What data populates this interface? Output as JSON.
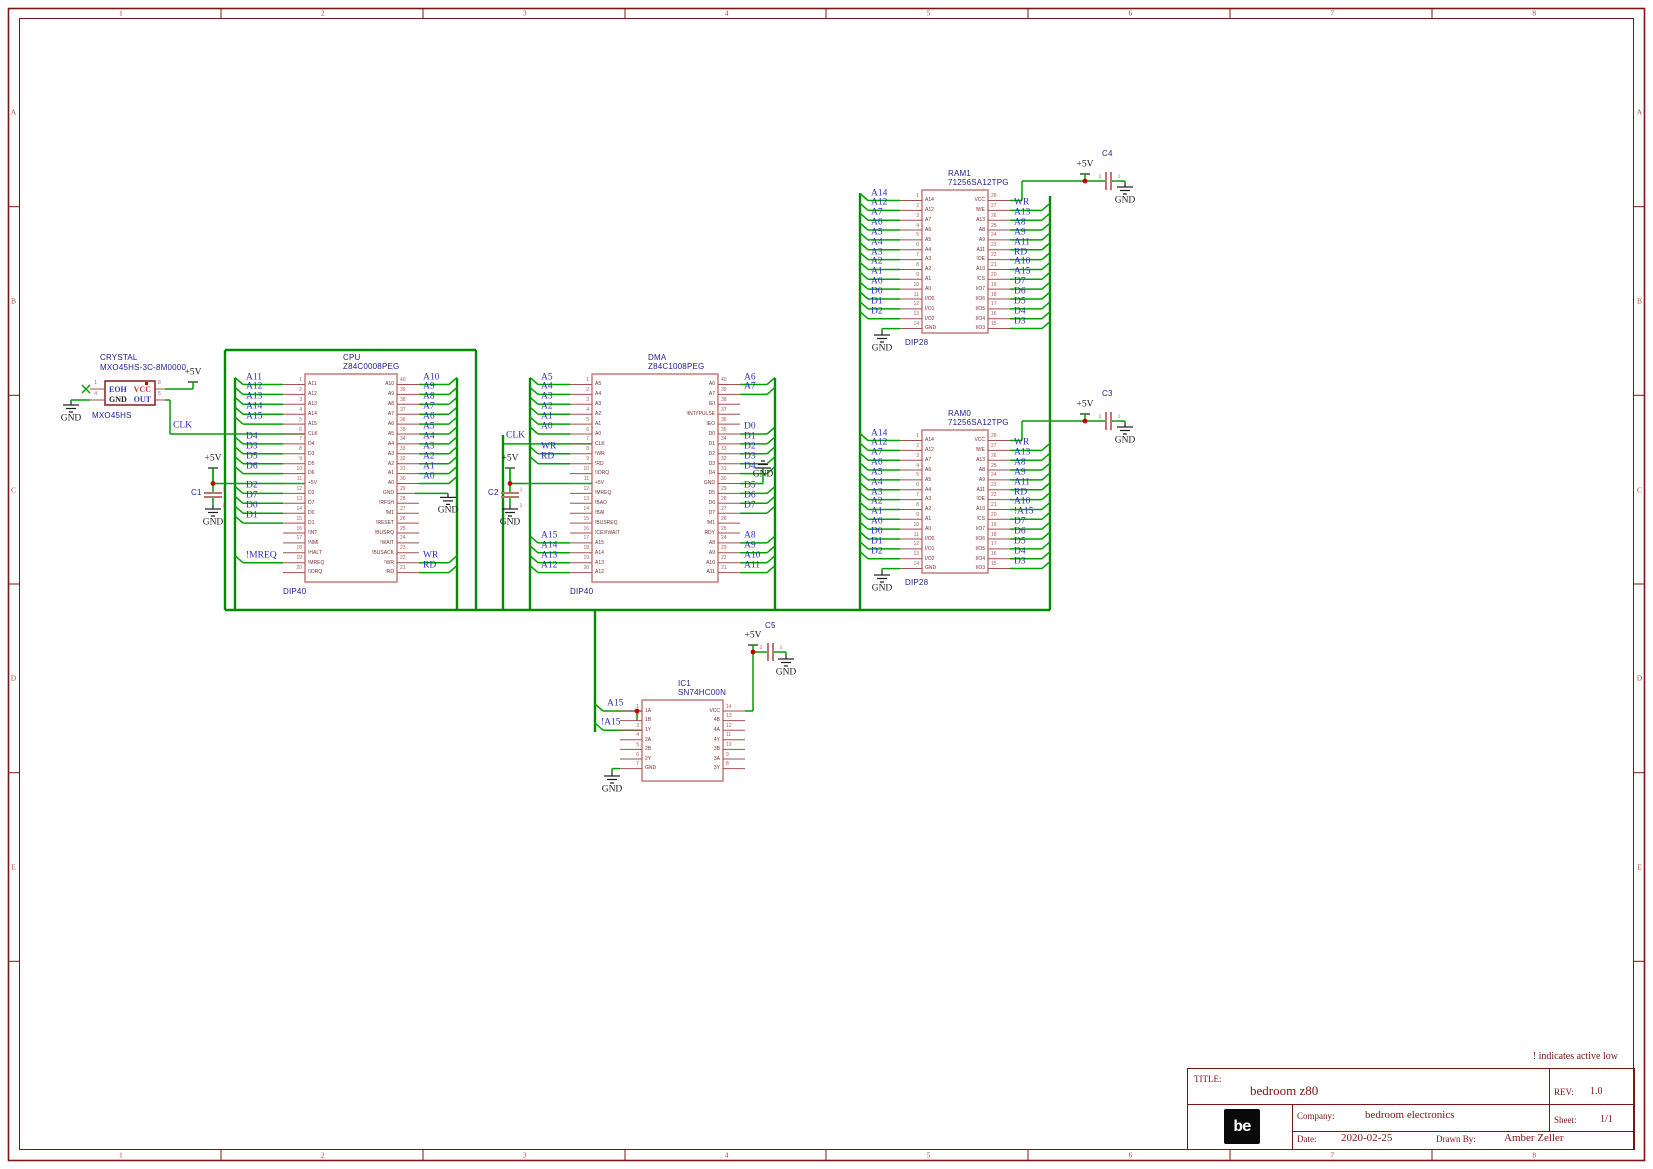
{
  "sheet": {
    "note": "! indicates active low",
    "frame": {
      "columns": [
        "1",
        "2",
        "3",
        "4",
        "5",
        "6",
        "7",
        "8"
      ],
      "rows": [
        "A",
        "B",
        "C",
        "D",
        "E"
      ]
    },
    "title_block": {
      "title_label": "TITLE:",
      "title": "bedroom z80",
      "rev_label": "REV:",
      "rev": "1.0",
      "company_label": "Company:",
      "company": "bedroom electronics",
      "sheet_label": "Sheet:",
      "sheet": "1/1",
      "date_label": "Date:",
      "date": "2020-02-25",
      "drawn_by_label": "Drawn By:",
      "drawn_by": "Amber Zeller",
      "logo_text": "be"
    }
  },
  "power": {
    "v5": "+5V",
    "gnd": "GND"
  },
  "labels": [
    "CLK",
    "CLK",
    "A15",
    "!A15"
  ],
  "colors": {
    "wire_green": "#00a000",
    "bus_green": "#008c00",
    "chip_outline": "#bf7373",
    "pin_stub": "#9e5252",
    "pin_number": "#b25858",
    "pin_name": "#7c2d2d",
    "net_label_blue": "#2d2dc4",
    "component_title_navy": "#1c1c91",
    "frame_red": "#7c1414",
    "junction_red": "#c00000",
    "symbol_black": "#1c1c1c"
  },
  "crystal": {
    "label_lines": [
      "CRYSTAL",
      "MXO45HS-3C-8M0000"
    ],
    "footprint": "MXO45HS",
    "pins": [
      {
        "num": "1",
        "name": "EOH"
      },
      {
        "num": "4",
        "name": "GND"
      },
      {
        "num": "8",
        "name": "VCC"
      },
      {
        "num": "5",
        "name": "OUT"
      }
    ]
  },
  "capacitors": [
    {
      "ref": "C1"
    },
    {
      "ref": "C2"
    },
    {
      "ref": "C3"
    },
    {
      "ref": "C4"
    },
    {
      "ref": "C5"
    }
  ],
  "chips": [
    {
      "ref": "CPU",
      "part": "Z84C0008PEG",
      "package": "DIP40",
      "left": [
        {
          "num": 1,
          "name": "A11",
          "net": "A11"
        },
        {
          "num": 2,
          "name": "A12",
          "net": "A12"
        },
        {
          "num": 3,
          "name": "A13",
          "net": "A13"
        },
        {
          "num": 4,
          "name": "A14",
          "net": "A14"
        },
        {
          "num": 5,
          "name": "A15",
          "net": "A15"
        },
        {
          "num": 6,
          "name": "CLK",
          "net": ""
        },
        {
          "num": 7,
          "name": "D4",
          "net": "D4"
        },
        {
          "num": 8,
          "name": "D3",
          "net": "D3"
        },
        {
          "num": 9,
          "name": "D5",
          "net": "D5"
        },
        {
          "num": 10,
          "name": "D6",
          "net": "D6"
        },
        {
          "num": 11,
          "name": "+5V",
          "net": ""
        },
        {
          "num": 12,
          "name": "D2",
          "net": "D2"
        },
        {
          "num": 13,
          "name": "D7",
          "net": "D7"
        },
        {
          "num": 14,
          "name": "D0",
          "net": "D0"
        },
        {
          "num": 15,
          "name": "D1",
          "net": "D1"
        },
        {
          "num": 16,
          "name": "!INT",
          "net": ""
        },
        {
          "num": 17,
          "name": "!NMI",
          "net": ""
        },
        {
          "num": 18,
          "name": "!HALT",
          "net": ""
        },
        {
          "num": 19,
          "name": "!MREQ",
          "net": "!MREQ"
        },
        {
          "num": 20,
          "name": "!IORQ",
          "net": ""
        }
      ],
      "right": [
        {
          "num": 40,
          "name": "A10",
          "net": "A10"
        },
        {
          "num": 39,
          "name": "A9",
          "net": "A9"
        },
        {
          "num": 38,
          "name": "A8",
          "net": "A8"
        },
        {
          "num": 37,
          "name": "A7",
          "net": "A7"
        },
        {
          "num": 36,
          "name": "A6",
          "net": "A6"
        },
        {
          "num": 35,
          "name": "A5",
          "net": "A5"
        },
        {
          "num": 34,
          "name": "A4",
          "net": "A4"
        },
        {
          "num": 33,
          "name": "A3",
          "net": "A3"
        },
        {
          "num": 32,
          "name": "A2",
          "net": "A2"
        },
        {
          "num": 31,
          "name": "A1",
          "net": "A1"
        },
        {
          "num": 30,
          "name": "A0",
          "net": "A0"
        },
        {
          "num": 29,
          "name": "GND",
          "net": ""
        },
        {
          "num": 28,
          "name": "!RFSH",
          "net": ""
        },
        {
          "num": 27,
          "name": "!M1",
          "net": ""
        },
        {
          "num": 26,
          "name": "!RESET",
          "net": ""
        },
        {
          "num": 25,
          "name": "!BUSRQ",
          "net": ""
        },
        {
          "num": 24,
          "name": "!WAIT",
          "net": ""
        },
        {
          "num": 23,
          "name": "!BUSACK",
          "net": ""
        },
        {
          "num": 22,
          "name": "!WR",
          "net": "WR"
        },
        {
          "num": 21,
          "name": "!RD",
          "net": "RD"
        }
      ]
    },
    {
      "ref": "DMA",
      "part": "Z84C1008PEG",
      "package": "DIP40",
      "left": [
        {
          "num": 1,
          "name": "A5",
          "net": "A5"
        },
        {
          "num": 2,
          "name": "A4",
          "net": "A4"
        },
        {
          "num": 3,
          "name": "A3",
          "net": "A3"
        },
        {
          "num": 4,
          "name": "A2",
          "net": "A2"
        },
        {
          "num": 5,
          "name": "A1",
          "net": "A1"
        },
        {
          "num": 6,
          "name": "A0",
          "net": "A0"
        },
        {
          "num": 7,
          "name": "CLK",
          "net": ""
        },
        {
          "num": 8,
          "name": "!WR",
          "net": "WR"
        },
        {
          "num": 9,
          "name": "!RD",
          "net": "RD"
        },
        {
          "num": 10,
          "name": "!IORQ",
          "net": ""
        },
        {
          "num": 11,
          "name": "+5V",
          "net": ""
        },
        {
          "num": 12,
          "name": "!MREQ",
          "net": ""
        },
        {
          "num": 13,
          "name": "!BAO",
          "net": ""
        },
        {
          "num": 14,
          "name": "!BAI",
          "net": ""
        },
        {
          "num": 15,
          "name": "!BUSREQ",
          "net": ""
        },
        {
          "num": 16,
          "name": "!CEI/!WAIT",
          "net": ""
        },
        {
          "num": 17,
          "name": "A15",
          "net": "A15"
        },
        {
          "num": 18,
          "name": "A14",
          "net": "A14"
        },
        {
          "num": 19,
          "name": "A13",
          "net": "A13"
        },
        {
          "num": 20,
          "name": "A12",
          "net": "A12"
        }
      ],
      "right": [
        {
          "num": 40,
          "name": "A6",
          "net": "A6"
        },
        {
          "num": 39,
          "name": "A7",
          "net": "A7"
        },
        {
          "num": 38,
          "name": "IEI",
          "net": ""
        },
        {
          "num": 37,
          "name": "!INT/!PULSE",
          "net": ""
        },
        {
          "num": 36,
          "name": "IEO",
          "net": ""
        },
        {
          "num": 35,
          "name": "D0",
          "net": "D0"
        },
        {
          "num": 34,
          "name": "D1",
          "net": "D1"
        },
        {
          "num": 33,
          "name": "D2",
          "net": "D2"
        },
        {
          "num": 32,
          "name": "D3",
          "net": "D3"
        },
        {
          "num": 31,
          "name": "D4",
          "net": "D4"
        },
        {
          "num": 30,
          "name": "GND",
          "net": ""
        },
        {
          "num": 29,
          "name": "D5",
          "net": "D5"
        },
        {
          "num": 28,
          "name": "D6",
          "net": "D6"
        },
        {
          "num": 27,
          "name": "D7",
          "net": "D7"
        },
        {
          "num": 26,
          "name": "!M1",
          "net": ""
        },
        {
          "num": 25,
          "name": "RDY",
          "net": ""
        },
        {
          "num": 24,
          "name": "A8",
          "net": "A8"
        },
        {
          "num": 23,
          "name": "A9",
          "net": "A9"
        },
        {
          "num": 22,
          "name": "A10",
          "net": "A10"
        },
        {
          "num": 21,
          "name": "A11",
          "net": "A11"
        }
      ]
    },
    {
      "ref": "RAM1",
      "part": "71256SA12TPG",
      "package": "DIP28",
      "left": [
        {
          "num": 1,
          "name": "A14",
          "net": "A14"
        },
        {
          "num": 2,
          "name": "A12",
          "net": "A12"
        },
        {
          "num": 3,
          "name": "A7",
          "net": "A7"
        },
        {
          "num": 4,
          "name": "A6",
          "net": "A6"
        },
        {
          "num": 5,
          "name": "A5",
          "net": "A5"
        },
        {
          "num": 6,
          "name": "A4",
          "net": "A4"
        },
        {
          "num": 7,
          "name": "A3",
          "net": "A3"
        },
        {
          "num": 8,
          "name": "A2",
          "net": "A2"
        },
        {
          "num": 9,
          "name": "A1",
          "net": "A1"
        },
        {
          "num": 10,
          "name": "A0",
          "net": "A0"
        },
        {
          "num": 11,
          "name": "I/O0",
          "net": "D0"
        },
        {
          "num": 12,
          "name": "I/O1",
          "net": "D1"
        },
        {
          "num": 13,
          "name": "I/O2",
          "net": "D2"
        },
        {
          "num": 14,
          "name": "GND",
          "net": ""
        }
      ],
      "right": [
        {
          "num": 28,
          "name": "VCC",
          "net": ""
        },
        {
          "num": 27,
          "name": "!WE",
          "net": "WR"
        },
        {
          "num": 26,
          "name": "A13",
          "net": "A13"
        },
        {
          "num": 25,
          "name": "A8",
          "net": "A8"
        },
        {
          "num": 24,
          "name": "A9",
          "net": "A9"
        },
        {
          "num": 23,
          "name": "A11",
          "net": "A11"
        },
        {
          "num": 22,
          "name": "!OE",
          "net": "RD"
        },
        {
          "num": 21,
          "name": "A10",
          "net": "A10"
        },
        {
          "num": 20,
          "name": "!CS",
          "net": "A15"
        },
        {
          "num": 19,
          "name": "I/O7",
          "net": "D7"
        },
        {
          "num": 18,
          "name": "I/O6",
          "net": "D6"
        },
        {
          "num": 17,
          "name": "I/O5",
          "net": "D5"
        },
        {
          "num": 16,
          "name": "I/O4",
          "net": "D4"
        },
        {
          "num": 15,
          "name": "I/O3",
          "net": "D3"
        }
      ]
    },
    {
      "ref": "RAM0",
      "part": "71256SA12TPG",
      "package": "DIP28",
      "left": [
        {
          "num": 1,
          "name": "A14",
          "net": "A14"
        },
        {
          "num": 2,
          "name": "A12",
          "net": "A12"
        },
        {
          "num": 3,
          "name": "A7",
          "net": "A7"
        },
        {
          "num": 4,
          "name": "A6",
          "net": "A6"
        },
        {
          "num": 5,
          "name": "A5",
          "net": "A5"
        },
        {
          "num": 6,
          "name": "A4",
          "net": "A4"
        },
        {
          "num": 7,
          "name": "A3",
          "net": "A3"
        },
        {
          "num": 8,
          "name": "A2",
          "net": "A2"
        },
        {
          "num": 9,
          "name": "A1",
          "net": "A1"
        },
        {
          "num": 10,
          "name": "A0",
          "net": "A0"
        },
        {
          "num": 11,
          "name": "I/O0",
          "net": "D0"
        },
        {
          "num": 12,
          "name": "I/O1",
          "net": "D1"
        },
        {
          "num": 13,
          "name": "I/O2",
          "net": "D2"
        },
        {
          "num": 14,
          "name": "GND",
          "net": ""
        }
      ],
      "right": [
        {
          "num": 28,
          "name": "VCC",
          "net": ""
        },
        {
          "num": 27,
          "name": "!WE",
          "net": "WR"
        },
        {
          "num": 26,
          "name": "A13",
          "net": "A13"
        },
        {
          "num": 25,
          "name": "A8",
          "net": "A8"
        },
        {
          "num": 24,
          "name": "A9",
          "net": "A9"
        },
        {
          "num": 23,
          "name": "A11",
          "net": "A11"
        },
        {
          "num": 22,
          "name": "!OE",
          "net": "RD"
        },
        {
          "num": 21,
          "name": "A10",
          "net": "A10"
        },
        {
          "num": 20,
          "name": "!CS",
          "net": "!A15"
        },
        {
          "num": 19,
          "name": "I/O7",
          "net": "D7"
        },
        {
          "num": 18,
          "name": "I/O6",
          "net": "D6"
        },
        {
          "num": 17,
          "name": "I/O5",
          "net": "D5"
        },
        {
          "num": 16,
          "name": "I/O4",
          "net": "D4"
        },
        {
          "num": 15,
          "name": "I/O3",
          "net": "D3"
        }
      ]
    },
    {
      "ref": "IC1",
      "part": "SN74HC00N",
      "package": "",
      "left": [
        {
          "num": 1,
          "name": "1A",
          "net": ""
        },
        {
          "num": 2,
          "name": "1B",
          "net": ""
        },
        {
          "num": 3,
          "name": "1Y",
          "net": ""
        },
        {
          "num": 4,
          "name": "2A",
          "net": ""
        },
        {
          "num": 5,
          "name": "2B",
          "net": ""
        },
        {
          "num": 6,
          "name": "2Y",
          "net": ""
        },
        {
          "num": 7,
          "name": "GND",
          "net": ""
        }
      ],
      "right": [
        {
          "num": 14,
          "name": "VCC",
          "net": ""
        },
        {
          "num": 13,
          "name": "4B",
          "net": ""
        },
        {
          "num": 12,
          "name": "4A",
          "net": ""
        },
        {
          "num": 11,
          "name": "4Y",
          "net": ""
        },
        {
          "num": 10,
          "name": "3B",
          "net": ""
        },
        {
          "num": 9,
          "name": "3A",
          "net": ""
        },
        {
          "num": 8,
          "name": "3Y",
          "net": ""
        }
      ]
    }
  ]
}
